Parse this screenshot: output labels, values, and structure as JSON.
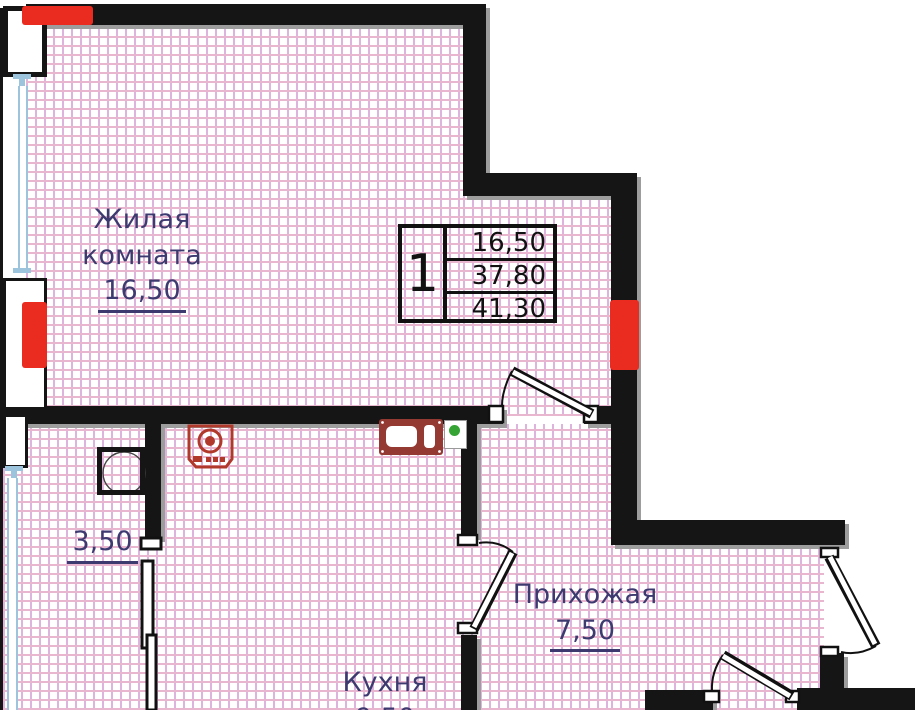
{
  "unit_info": {
    "rooms_count": "1",
    "areas": [
      "16,50",
      "37,80",
      "41,30"
    ]
  },
  "rooms": {
    "living": {
      "line1": "Жилая",
      "line2": "комната",
      "area": "16,50"
    },
    "bathroom": {
      "area": "3,50"
    },
    "hallway": {
      "name": "Прихожая",
      "area": "7,50"
    },
    "kitchen": {
      "name": "Кухня",
      "area": "9,50"
    }
  },
  "icons": [
    "washing-machine-icon",
    "kitchen-sink-icon",
    "status-dot-icon",
    "shower-tray-icon"
  ],
  "colors": {
    "wall": "#151515",
    "accent_red": "#ea2b1f",
    "label_navy": "#3d3a70",
    "grid_pink": "#e9b6cf",
    "window_blue": "#9cc4dd",
    "appliance_red": "#b0392c",
    "sink_maroon": "#943a33",
    "dot_green": "#35a435"
  }
}
